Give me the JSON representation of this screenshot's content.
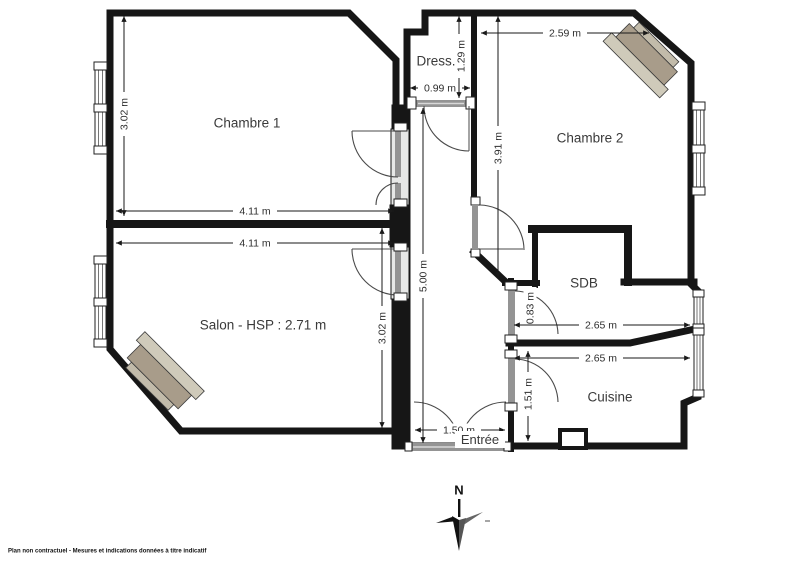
{
  "plan": {
    "rooms": {
      "chambre1": "Chambre 1",
      "chambre2": "Chambre 2",
      "dressing": "Dress.",
      "salon": "Salon - HSP : 2.71 m",
      "sdb": "SDB",
      "cuisine": "Cuisine",
      "entree": "Entrée"
    },
    "dims": {
      "c1_width": "4.11 m",
      "c1_height": "3.02 m",
      "salon_width": "4.11 m",
      "salon_height": "3.02 m",
      "hall_length": "5.00 m",
      "dress_width": "0.99 m",
      "dress_height": "1.29 m",
      "c2_width": "2.59 m",
      "c2_height": "3.91 m",
      "sdb_door": "0.83 m",
      "sdb_width": "2.65 m",
      "kitchen_width": "2.65 m",
      "kitchen_depth": "1.51 m",
      "entry_width": "1.50 m"
    },
    "compass": {
      "north_label": "N"
    },
    "footer": "Plan non contractuel - Mesures et indications données à titre indicatif",
    "colors": {
      "floor": "#e7e8e7",
      "wall": "#161616",
      "door_band": "#949494",
      "fireplace_near": "#c2bbaa",
      "fireplace_dark": "#a89c8a",
      "fireplace_light": "#cfcaba"
    }
  }
}
